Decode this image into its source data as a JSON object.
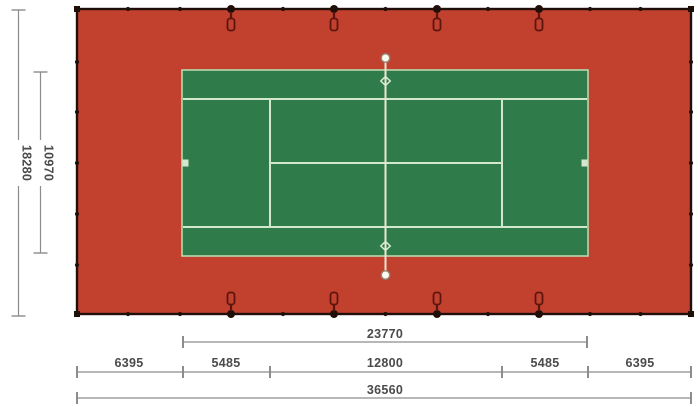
{
  "title": "Tennis court dimension plan",
  "colors": {
    "surround_red": "#c2412e",
    "court_green": "#2f7c4a",
    "court_line": "#d3e7cf",
    "court_border": "#b9d8ae",
    "net_line": "#ece5cf",
    "edge_black": "#200f08",
    "tag_outline": "#5c150e",
    "dim_line": "#8c8c8c",
    "dim_text": "#4a4a4a"
  },
  "dimensions": {
    "vertical_outer": "18280",
    "vertical_inner": "10970",
    "horizontal_court_length": "23770",
    "horizontal_row": [
      "6395",
      "5485",
      "12800",
      "5485",
      "6395"
    ],
    "horizontal_total": "36560"
  }
}
